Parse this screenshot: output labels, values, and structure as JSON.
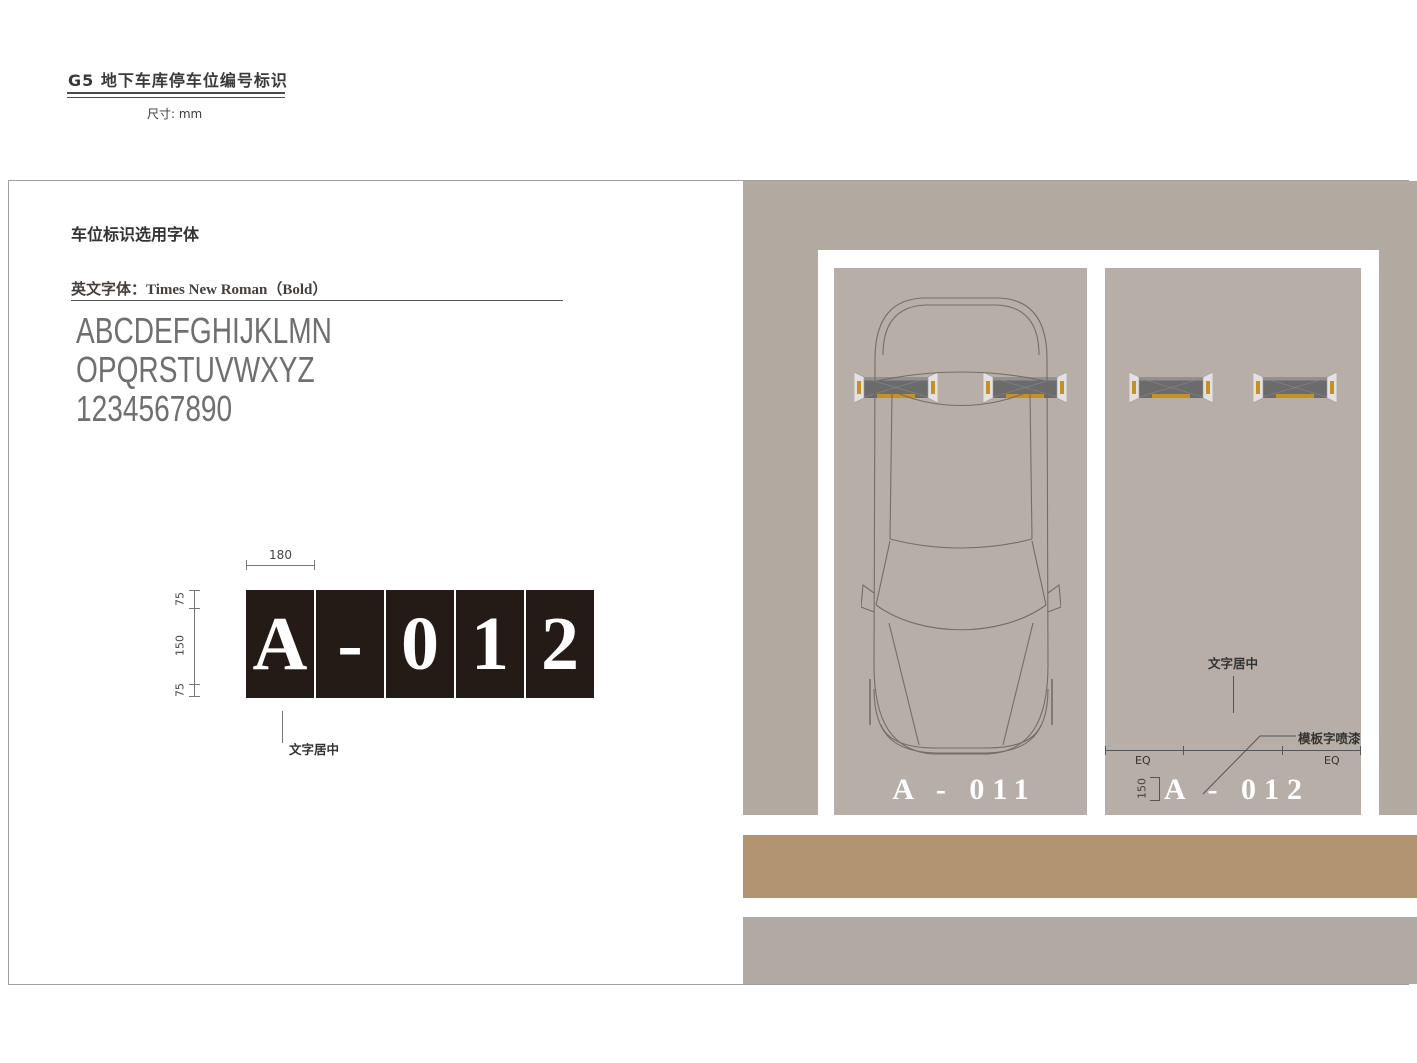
{
  "header": {
    "title": "G5 地下车库停车位编号标识",
    "unit": "尺寸: mm"
  },
  "font_section": {
    "title": "车位标识选用字体",
    "subtitle": "英文字体：Times New Roman（Bold）",
    "alphabet": [
      "ABCDEFGHIJKLMN",
      "OPQRSTUVWXYZ",
      "1234567890"
    ]
  },
  "sign_spec": {
    "characters": [
      "A",
      "-",
      "0",
      "1",
      "2"
    ],
    "dims": {
      "width": "180",
      "top": "75",
      "middle": "150",
      "bottom": "75"
    },
    "note": "文字居中",
    "panel_color": "#241b16",
    "text_color": "#ffffff"
  },
  "parking_view": {
    "spaces": [
      {
        "number": "A - 011",
        "has_car": true
      },
      {
        "number": "A - 012",
        "has_car": false
      }
    ],
    "annotations": {
      "center_note": "文字居中",
      "paint_note": "模板字喷漆",
      "eq_left": "EQ",
      "eq_right": "EQ",
      "text_height": "150"
    },
    "colors": {
      "floor": "#b2a9a1",
      "space": "#b7afa7",
      "marking": "#ffffff",
      "lane": "#b29470",
      "curb": "#b1aaa4",
      "stop_stripe": "#c59122"
    }
  }
}
